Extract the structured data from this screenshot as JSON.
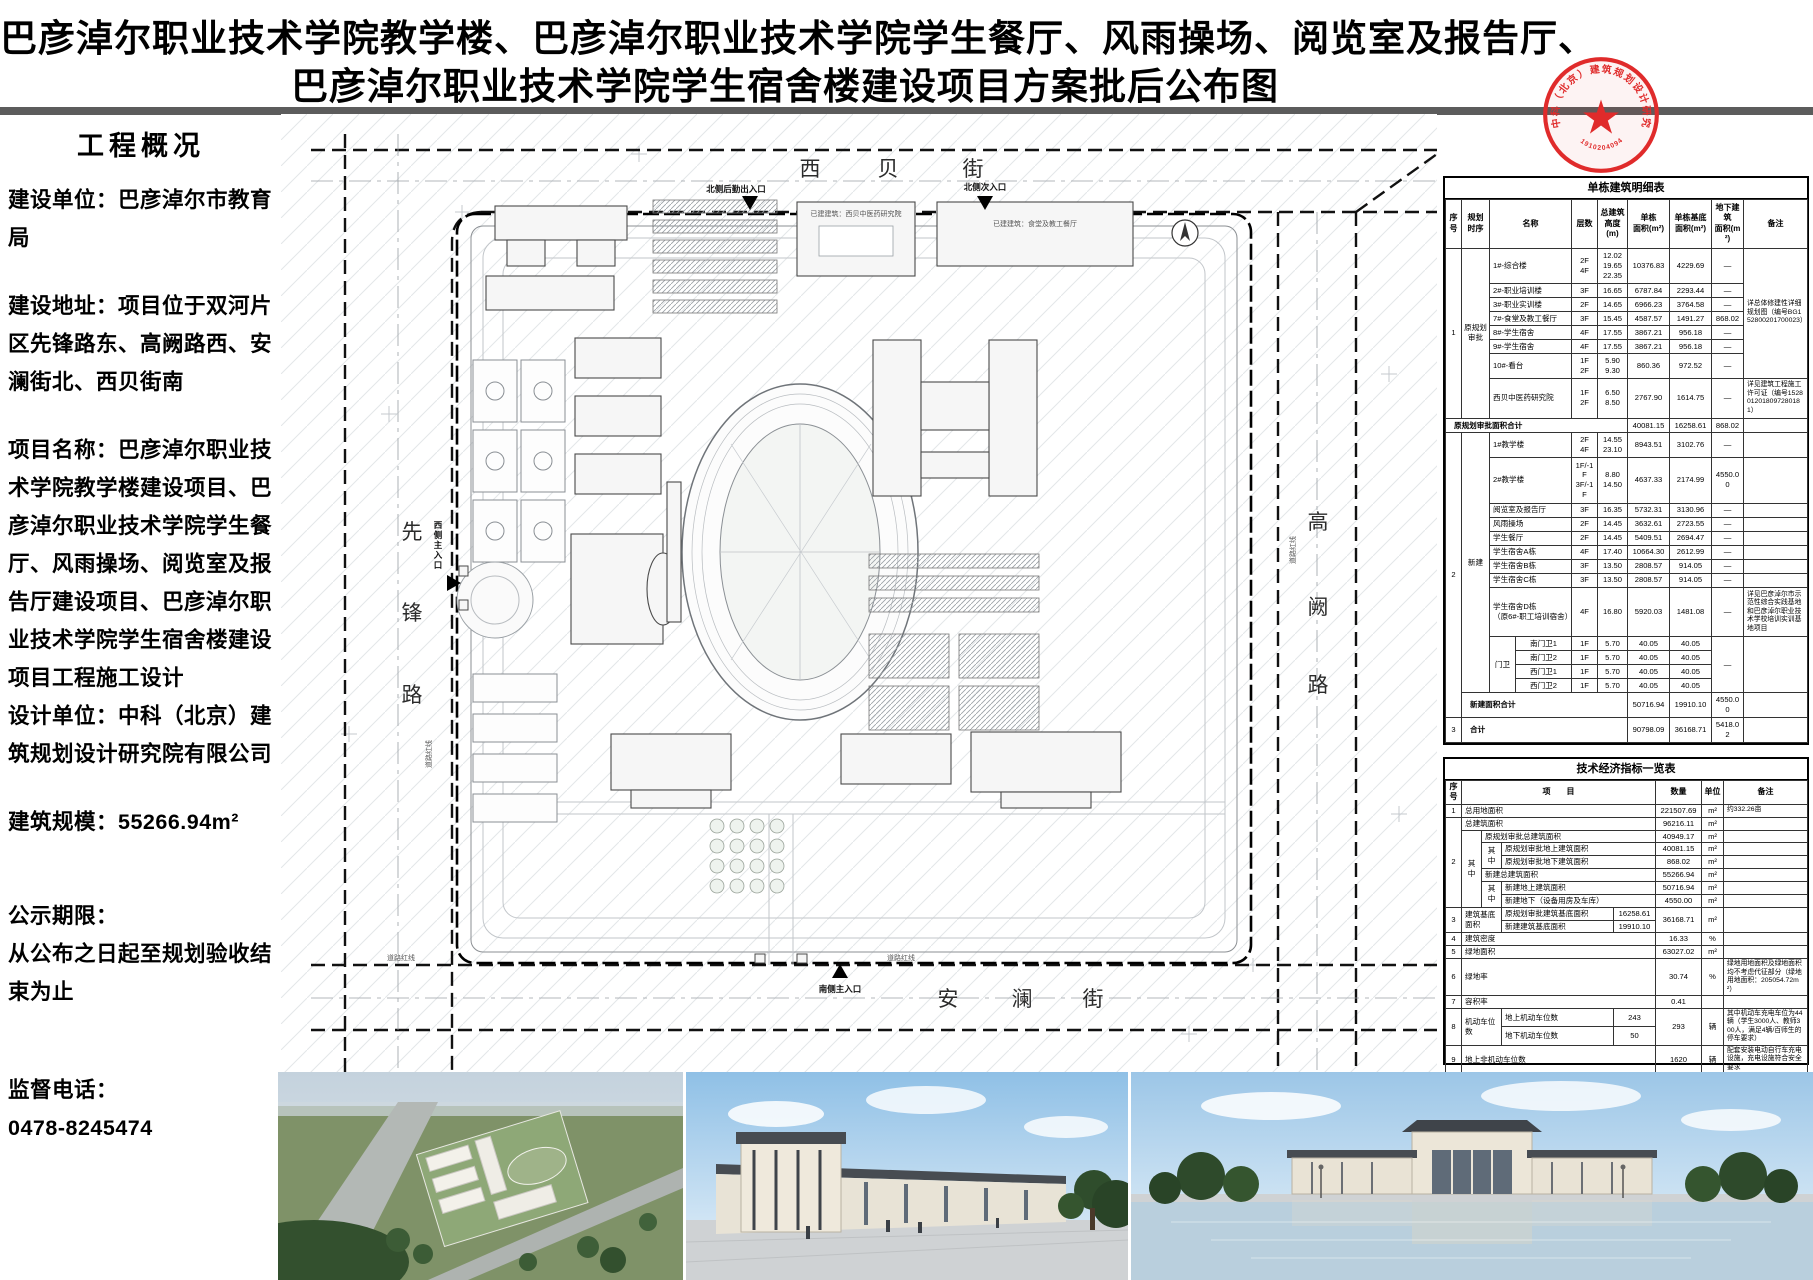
{
  "title": {
    "line1": "巴彦淖尔职业技术学院教学楼、巴彦淖尔职业技术学院学生餐厅、风雨操场、阅览室及报告厅、",
    "line2": "巴彦淖尔职业技术学院学生宿舍楼建设项目方案批后公布图"
  },
  "seal": {
    "company": "中科（北京）建筑规划设计研究院有限公司",
    "number": "191020409465"
  },
  "sidebar": {
    "heading": "工程概况",
    "p_unit": "建设单位：巴彦淖尔市教育局",
    "p_addr": "建设地址：项目位于双河片区先锋路东、高阙路西、安澜街北、西贝街南",
    "p_name": "项目名称：巴彦淖尔职业技术学院教学楼建设项目、巴彦淖尔职业技术学院学生餐厅、风雨操场、阅览室及报告厅建设项目、巴彦淖尔职业技术学院学生宿舍楼建设项目工程施工设计",
    "p_designer": "设计单位：中科（北京）建筑规划设计研究院有限公司",
    "p_scale": "建筑规模：55266.94m²",
    "p_period_label": "公示期限：",
    "p_period": "从公布之日起至规划验收结束为止",
    "p_phone_label": "监督电话：",
    "p_phone": "0478-8245474"
  },
  "site_plan": {
    "streets": {
      "north": [
        "西",
        "贝",
        "街"
      ],
      "south": [
        "安",
        "澜",
        "街"
      ],
      "west": [
        "先",
        "锋",
        "路"
      ],
      "east": [
        "高",
        "阙",
        "路"
      ]
    },
    "entrances": {
      "north_service": "北侧后勤出入口",
      "north_secondary": "北侧次入口",
      "west_main": "西侧主入口",
      "south_main": "南侧主入口"
    },
    "labels": {
      "road_red_line": "道路红线",
      "existing_research": "已建建筑：西贝中医药研究院",
      "existing_canteen": "已建建筑：食堂及教工餐厅"
    }
  },
  "building_table": {
    "title": "单栋建筑明细表",
    "rows": [
      [
        {
          "t": "序号",
          "cl": "hd"
        },
        {
          "t": "规划\n时序",
          "cl": "hd"
        },
        {
          "t": "名称",
          "cs": 2,
          "cl": "hd"
        },
        {
          "t": "层数",
          "cl": "hd"
        },
        {
          "t": "总建筑\n高度(m)",
          "cl": "hd"
        },
        {
          "t": "单栋\n面积(m²)",
          "cl": "hd"
        },
        {
          "t": "单栋基底\n面积(m²)",
          "cl": "hd"
        },
        {
          "t": "地下建筑\n面积(m²)",
          "cl": "hd"
        },
        {
          "t": "备注",
          "cl": "hd"
        }
      ],
      [
        {
          "t": "1",
          "rs": 8
        },
        {
          "t": "原规划\n审批",
          "rs": 8
        },
        {
          "t": "1#-综合楼",
          "cs": 2,
          "cl": "nm"
        },
        {
          "t": "2F\n4F"
        },
        {
          "t": "12.02\n19.65\n22.35"
        },
        {
          "t": "10376.83"
        },
        {
          "t": "4229.69"
        },
        {
          "t": "—"
        },
        {
          "t": "详总体修建性详细规划图（编号BG152800201700023）",
          "rs": 7,
          "cl": "rk"
        }
      ],
      [
        {
          "t": "2#-职业培训楼",
          "cs": 2,
          "cl": "nm"
        },
        {
          "t": "3F"
        },
        {
          "t": "16.65"
        },
        {
          "t": "6787.84"
        },
        {
          "t": "2293.44"
        },
        {
          "t": "—"
        }
      ],
      [
        {
          "t": "3#-职业实训楼",
          "cs": 2,
          "cl": "nm"
        },
        {
          "t": "2F"
        },
        {
          "t": "14.65"
        },
        {
          "t": "6966.23"
        },
        {
          "t": "3764.58"
        },
        {
          "t": "—"
        }
      ],
      [
        {
          "t": "7#-食堂及教工餐厅",
          "cs": 2,
          "cl": "nm"
        },
        {
          "t": "3F"
        },
        {
          "t": "15.45"
        },
        {
          "t": "4587.57"
        },
        {
          "t": "1491.27"
        },
        {
          "t": "868.02"
        }
      ],
      [
        {
          "t": "8#-学生宿舍",
          "cs": 2,
          "cl": "nm"
        },
        {
          "t": "4F"
        },
        {
          "t": "17.55"
        },
        {
          "t": "3867.21"
        },
        {
          "t": "956.18"
        },
        {
          "t": "—"
        }
      ],
      [
        {
          "t": "9#-学生宿舍",
          "cs": 2,
          "cl": "nm"
        },
        {
          "t": "4F"
        },
        {
          "t": "17.55"
        },
        {
          "t": "3867.21"
        },
        {
          "t": "956.18"
        },
        {
          "t": "—"
        }
      ],
      [
        {
          "t": "10#-看台",
          "cs": 2,
          "cl": "nm"
        },
        {
          "t": "1F\n2F"
        },
        {
          "t": "5.90\n9.30"
        },
        {
          "t": "860.36"
        },
        {
          "t": "972.52"
        },
        {
          "t": "—"
        }
      ],
      [
        {
          "t": "西贝中医药研究院",
          "cs": 2,
          "cl": "nm"
        },
        {
          "t": "1F\n2F"
        },
        {
          "t": "6.50\n8.50"
        },
        {
          "t": "2767.90"
        },
        {
          "t": "1614.75"
        },
        {
          "t": "—"
        },
        {
          "t": "详见建筑工程施工许可证（编号1528012018097280181）",
          "cl": "rk"
        }
      ],
      [
        {
          "t": "原规划审批面积合计",
          "cs": 6,
          "cl": "sum"
        },
        {
          "t": "40081.15"
        },
        {
          "t": "16258.61"
        },
        {
          "t": "868.02"
        },
        {
          "t": ""
        }
      ],
      [
        {
          "t": "2",
          "rs": 14
        },
        {
          "t": "新建",
          "rs": 13
        },
        {
          "t": "1#教学楼",
          "cs": 2,
          "cl": "nm"
        },
        {
          "t": "2F\n4F"
        },
        {
          "t": "14.55\n23.10"
        },
        {
          "t": "8943.51"
        },
        {
          "t": "3102.76"
        },
        {
          "t": "—"
        },
        {
          "t": ""
        }
      ],
      [
        {
          "t": "2#教学楼",
          "cs": 2,
          "cl": "nm"
        },
        {
          "t": "1F/-1F\n3F/-1F"
        },
        {
          "t": "8.80\n14.50"
        },
        {
          "t": "4637.33"
        },
        {
          "t": "2174.99"
        },
        {
          "t": "4550.00"
        },
        {
          "t": ""
        }
      ],
      [
        {
          "t": "阅览室及报告厅",
          "cs": 2,
          "cl": "nm"
        },
        {
          "t": "3F"
        },
        {
          "t": "16.35"
        },
        {
          "t": "5732.31"
        },
        {
          "t": "3130.96"
        },
        {
          "t": "—"
        },
        {
          "t": ""
        }
      ],
      [
        {
          "t": "风雨操场",
          "cs": 2,
          "cl": "nm"
        },
        {
          "t": "2F"
        },
        {
          "t": "14.45"
        },
        {
          "t": "3632.61"
        },
        {
          "t": "2723.55"
        },
        {
          "t": "—"
        },
        {
          "t": ""
        }
      ],
      [
        {
          "t": "学生餐厅",
          "cs": 2,
          "cl": "nm"
        },
        {
          "t": "2F"
        },
        {
          "t": "14.45"
        },
        {
          "t": "5409.51"
        },
        {
          "t": "2694.47"
        },
        {
          "t": "—"
        },
        {
          "t": ""
        }
      ],
      [
        {
          "t": "学生宿舍A栋",
          "cs": 2,
          "cl": "nm"
        },
        {
          "t": "4F"
        },
        {
          "t": "17.40"
        },
        {
          "t": "10664.30"
        },
        {
          "t": "2612.99"
        },
        {
          "t": "—"
        },
        {
          "t": ""
        }
      ],
      [
        {
          "t": "学生宿舍B栋",
          "cs": 2,
          "cl": "nm"
        },
        {
          "t": "3F"
        },
        {
          "t": "13.50"
        },
        {
          "t": "2808.57"
        },
        {
          "t": "914.05"
        },
        {
          "t": "—"
        },
        {
          "t": ""
        }
      ],
      [
        {
          "t": "学生宿舍C栋",
          "cs": 2,
          "cl": "nm"
        },
        {
          "t": "3F"
        },
        {
          "t": "13.50"
        },
        {
          "t": "2808.57"
        },
        {
          "t": "914.05"
        },
        {
          "t": "—"
        },
        {
          "t": ""
        }
      ],
      [
        {
          "t": "学生宿舍D栋\n（原6#-职工培训宿舍）",
          "cs": 2,
          "cl": "nm"
        },
        {
          "t": "4F"
        },
        {
          "t": "16.80"
        },
        {
          "t": "5920.03"
        },
        {
          "t": "1481.08"
        },
        {
          "t": "—"
        },
        {
          "t": "详见巴彦淖尔市示范性综合实践基地和巴彦淖尔职业技术学校培训实训基地项目",
          "cl": "rk"
        }
      ],
      [
        {
          "t": "门卫",
          "rs": 4
        },
        {
          "t": "南门卫1"
        },
        {
          "t": "1F"
        },
        {
          "t": "5.70"
        },
        {
          "t": "40.05"
        },
        {
          "t": "40.05"
        },
        {
          "t": "—",
          "rs": 4
        },
        {
          "t": "",
          "rs": 4
        }
      ],
      [
        {
          "t": "南门卫2"
        },
        {
          "t": "1F"
        },
        {
          "t": "5.70"
        },
        {
          "t": "40.05"
        },
        {
          "t": "40.05"
        }
      ],
      [
        {
          "t": "西门卫1"
        },
        {
          "t": "1F"
        },
        {
          "t": "5.70"
        },
        {
          "t": "40.05"
        },
        {
          "t": "40.05"
        }
      ],
      [
        {
          "t": "西门卫2"
        },
        {
          "t": "1F"
        },
        {
          "t": "5.70"
        },
        {
          "t": "40.05"
        },
        {
          "t": "40.05"
        }
      ],
      [
        {
          "t": "新建面积合计",
          "cs": 5,
          "cl": "sum"
        },
        {
          "t": "50716.94"
        },
        {
          "t": "19910.10"
        },
        {
          "t": "4550.00"
        },
        {
          "t": ""
        }
      ],
      [
        {
          "t": "3"
        },
        {
          "t": "合计",
          "cs": 5,
          "cl": "sum"
        },
        {
          "t": "90798.09"
        },
        {
          "t": "36168.71"
        },
        {
          "t": "5418.02"
        },
        {
          "t": ""
        }
      ]
    ]
  },
  "indicator_table": {
    "title": "技术经济指标一览表",
    "rows": [
      [
        {
          "t": "序号",
          "cl": "hd"
        },
        {
          "t": "项　　目",
          "cs": 4,
          "cl": "hd"
        },
        {
          "t": "数量",
          "cl": "hd"
        },
        {
          "t": "单位",
          "cl": "hd"
        },
        {
          "t": "备注",
          "cl": "hd"
        }
      ],
      [
        {
          "t": "1"
        },
        {
          "t": "总用地面积",
          "cs": 4,
          "cl": "lt"
        },
        {
          "t": "221507.69"
        },
        {
          "t": "m²"
        },
        {
          "t": "约332.26亩",
          "cl": "rk"
        }
      ],
      [
        {
          "t": "2",
          "rs": 7
        },
        {
          "t": "总建筑面积",
          "cs": 4,
          "cl": "lt"
        },
        {
          "t": "96216.11"
        },
        {
          "t": "m²"
        },
        {
          "t": ""
        }
      ],
      [
        {
          "t": "其中",
          "rs": 6
        },
        {
          "t": "原规划审批总建筑面积",
          "cs": 3,
          "cl": "lt"
        },
        {
          "t": "40949.17"
        },
        {
          "t": "m²"
        },
        {
          "t": ""
        }
      ],
      [
        {
          "t": "其中",
          "rs": 2
        },
        {
          "t": "原规划审批地上建筑面积",
          "cs": 2,
          "cl": "lt"
        },
        {
          "t": "40081.15"
        },
        {
          "t": "m²"
        },
        {
          "t": ""
        }
      ],
      [
        {
          "t": "原规划审批地下建筑面积",
          "cs": 2,
          "cl": "lt"
        },
        {
          "t": "868.02"
        },
        {
          "t": "m²"
        },
        {
          "t": ""
        }
      ],
      [
        {
          "t": "新建总建筑面积",
          "cs": 3,
          "cl": "lt"
        },
        {
          "t": "55266.94"
        },
        {
          "t": "m²"
        },
        {
          "t": ""
        }
      ],
      [
        {
          "t": "其中",
          "rs": 2
        },
        {
          "t": "新建地上建筑面积",
          "cs": 2,
          "cl": "lt"
        },
        {
          "t": "50716.94"
        },
        {
          "t": "m²"
        },
        {
          "t": ""
        }
      ],
      [
        {
          "t": "新建地下（设备用房及车库）",
          "cs": 2,
          "cl": "lt"
        },
        {
          "t": "4550.00"
        },
        {
          "t": "m²"
        },
        {
          "t": ""
        }
      ],
      [
        {
          "t": "3",
          "rs": 2
        },
        {
          "t": "建筑基底面积",
          "cs": 2,
          "rs": 2,
          "cl": "lt"
        },
        {
          "t": "原规划审批建筑基底面积",
          "cl": "lt"
        },
        {
          "t": "16258.61"
        },
        {
          "t": "36168.71",
          "rs": 2
        },
        {
          "t": "m²",
          "rs": 2
        },
        {
          "t": "",
          "rs": 2
        }
      ],
      [
        {
          "t": "新建建筑基底面积",
          "cl": "lt"
        },
        {
          "t": "19910.10"
        }
      ],
      [
        {
          "t": "4"
        },
        {
          "t": "建筑密度",
          "cs": 4,
          "cl": "lt"
        },
        {
          "t": "16.33"
        },
        {
          "t": "%"
        },
        {
          "t": ""
        }
      ],
      [
        {
          "t": "5"
        },
        {
          "t": "绿地面积",
          "cs": 4,
          "cl": "lt"
        },
        {
          "t": "63027.02"
        },
        {
          "t": "m²"
        },
        {
          "t": ""
        }
      ],
      [
        {
          "t": "6"
        },
        {
          "t": "绿地率",
          "cs": 4,
          "cl": "lt"
        },
        {
          "t": "30.74"
        },
        {
          "t": "%"
        },
        {
          "t": "绿地用地面积及绿地面积均不考虑代征部分（绿地用地面积：205054.72m²）",
          "cl": "rk"
        }
      ],
      [
        {
          "t": "7"
        },
        {
          "t": "容积率",
          "cs": 4,
          "cl": "lt"
        },
        {
          "t": "0.41"
        },
        {
          "t": ""
        },
        {
          "t": ""
        }
      ],
      [
        {
          "t": "8",
          "rs": 2
        },
        {
          "t": "机动车位数",
          "cs": 2,
          "rs": 2,
          "cl": "lt"
        },
        {
          "t": "地上机动车位数",
          "cl": "lt"
        },
        {
          "t": "243"
        },
        {
          "t": "293",
          "rs": 2
        },
        {
          "t": "辆",
          "rs": 2
        },
        {
          "t": "其中机动车充电车位为44辆（学生3000人、教师300人，满足4辆/百师生的停车要求）",
          "rs": 2,
          "cl": "rk"
        }
      ],
      [
        {
          "t": "地下机动车位数",
          "cl": "lt"
        },
        {
          "t": "50"
        }
      ],
      [
        {
          "t": "9"
        },
        {
          "t": "地上非机动车位数",
          "cs": 4,
          "cl": "lt"
        },
        {
          "t": "1620"
        },
        {
          "t": "辆"
        },
        {
          "t": "配套安装电动自行车充电设施，充电设施符合安全要求",
          "cl": "rk"
        }
      ]
    ]
  }
}
